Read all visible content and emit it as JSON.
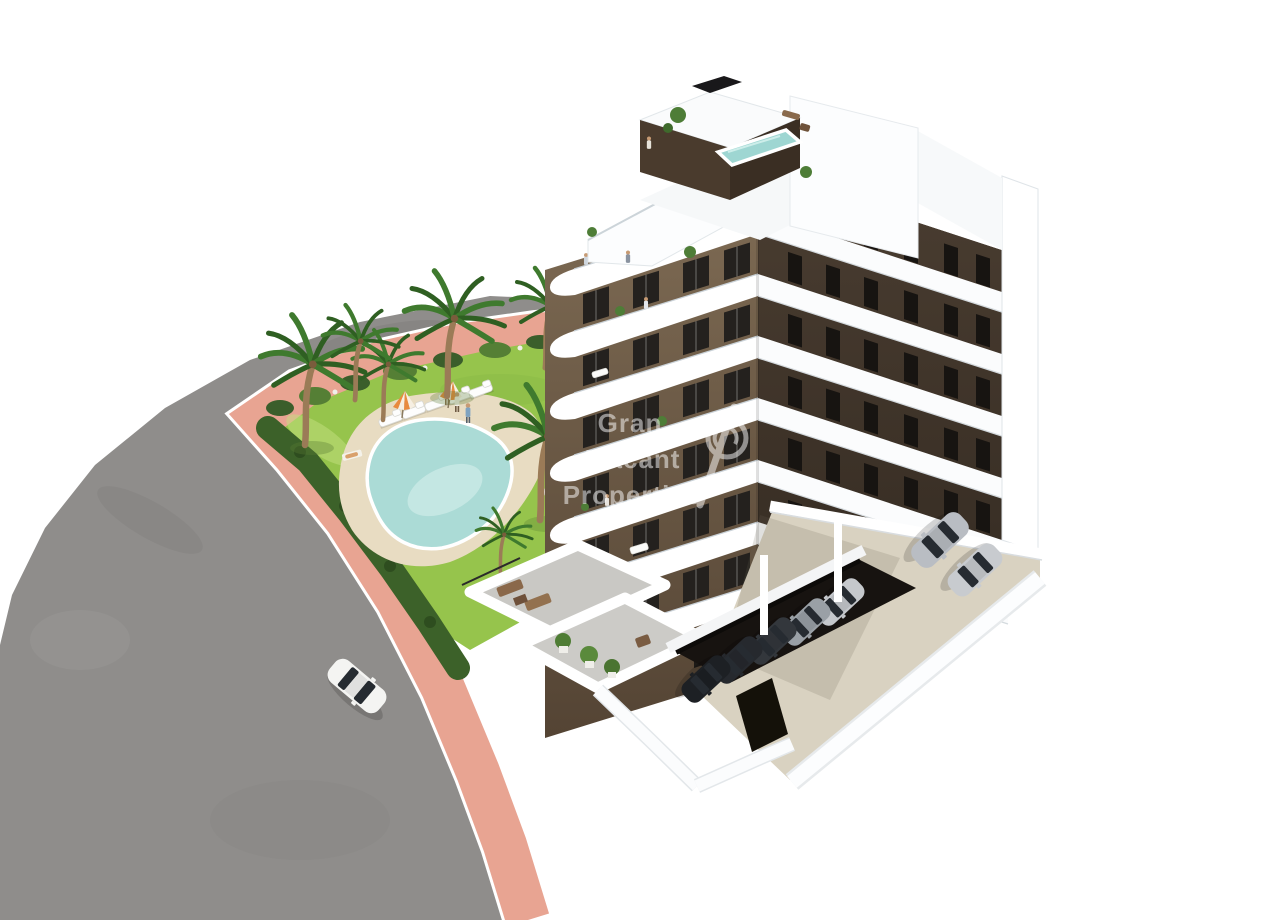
{
  "image": {
    "kind": "3D architectural rendering (real-estate marketing visual)",
    "scene": "Aerial view of a modern apartment block with dark-brown facade panels and white wrap-around balcony bands, rooftop solarium with plunge pool, landscaped garden with free-form swimming pool, palm trees, curved asphalt road with salmon-pink sidewalk, a white car driving and a residents parking area with cars",
    "background_color": "#ffffff"
  },
  "watermark": {
    "line1": "Gran",
    "line2": "Alacant",
    "line3": "Properties",
    "separator_glyph": "/",
    "logo": "swirl-circle-logo",
    "text_color": "#ffffff",
    "opacity": 0.5
  },
  "palette": {
    "asphalt": "#8f8d8b",
    "sidewalk_pink": "#e8a492",
    "lawn_green": "#96c44c",
    "hedge_green": "#3c6129",
    "pool_water": "#abdbd6",
    "deck_beige": "#e8dcc2",
    "parking_concrete": "#d9d2c1",
    "facade_brown": "#6a5742",
    "facade_brown_dark": "#42362b",
    "white_bands": "#ffffff",
    "window_dark": "#24211e",
    "roof_pool": "#9ed6d2",
    "car_white": "#f4f4f2",
    "car_silver": "#b9bdc3"
  },
  "counts": {
    "building_floors": 7,
    "balcony_bands_left": 7,
    "balcony_bands_right": 6,
    "palm_trees": 7,
    "sun_loungers": 5,
    "parasols": 2,
    "garden_people": 4,
    "rooftop_people": 2,
    "balcony_people": 3,
    "cars_driving": 1,
    "cars_parked_open_lot": 2,
    "cars_parked_covered": 5,
    "pools": 2
  }
}
